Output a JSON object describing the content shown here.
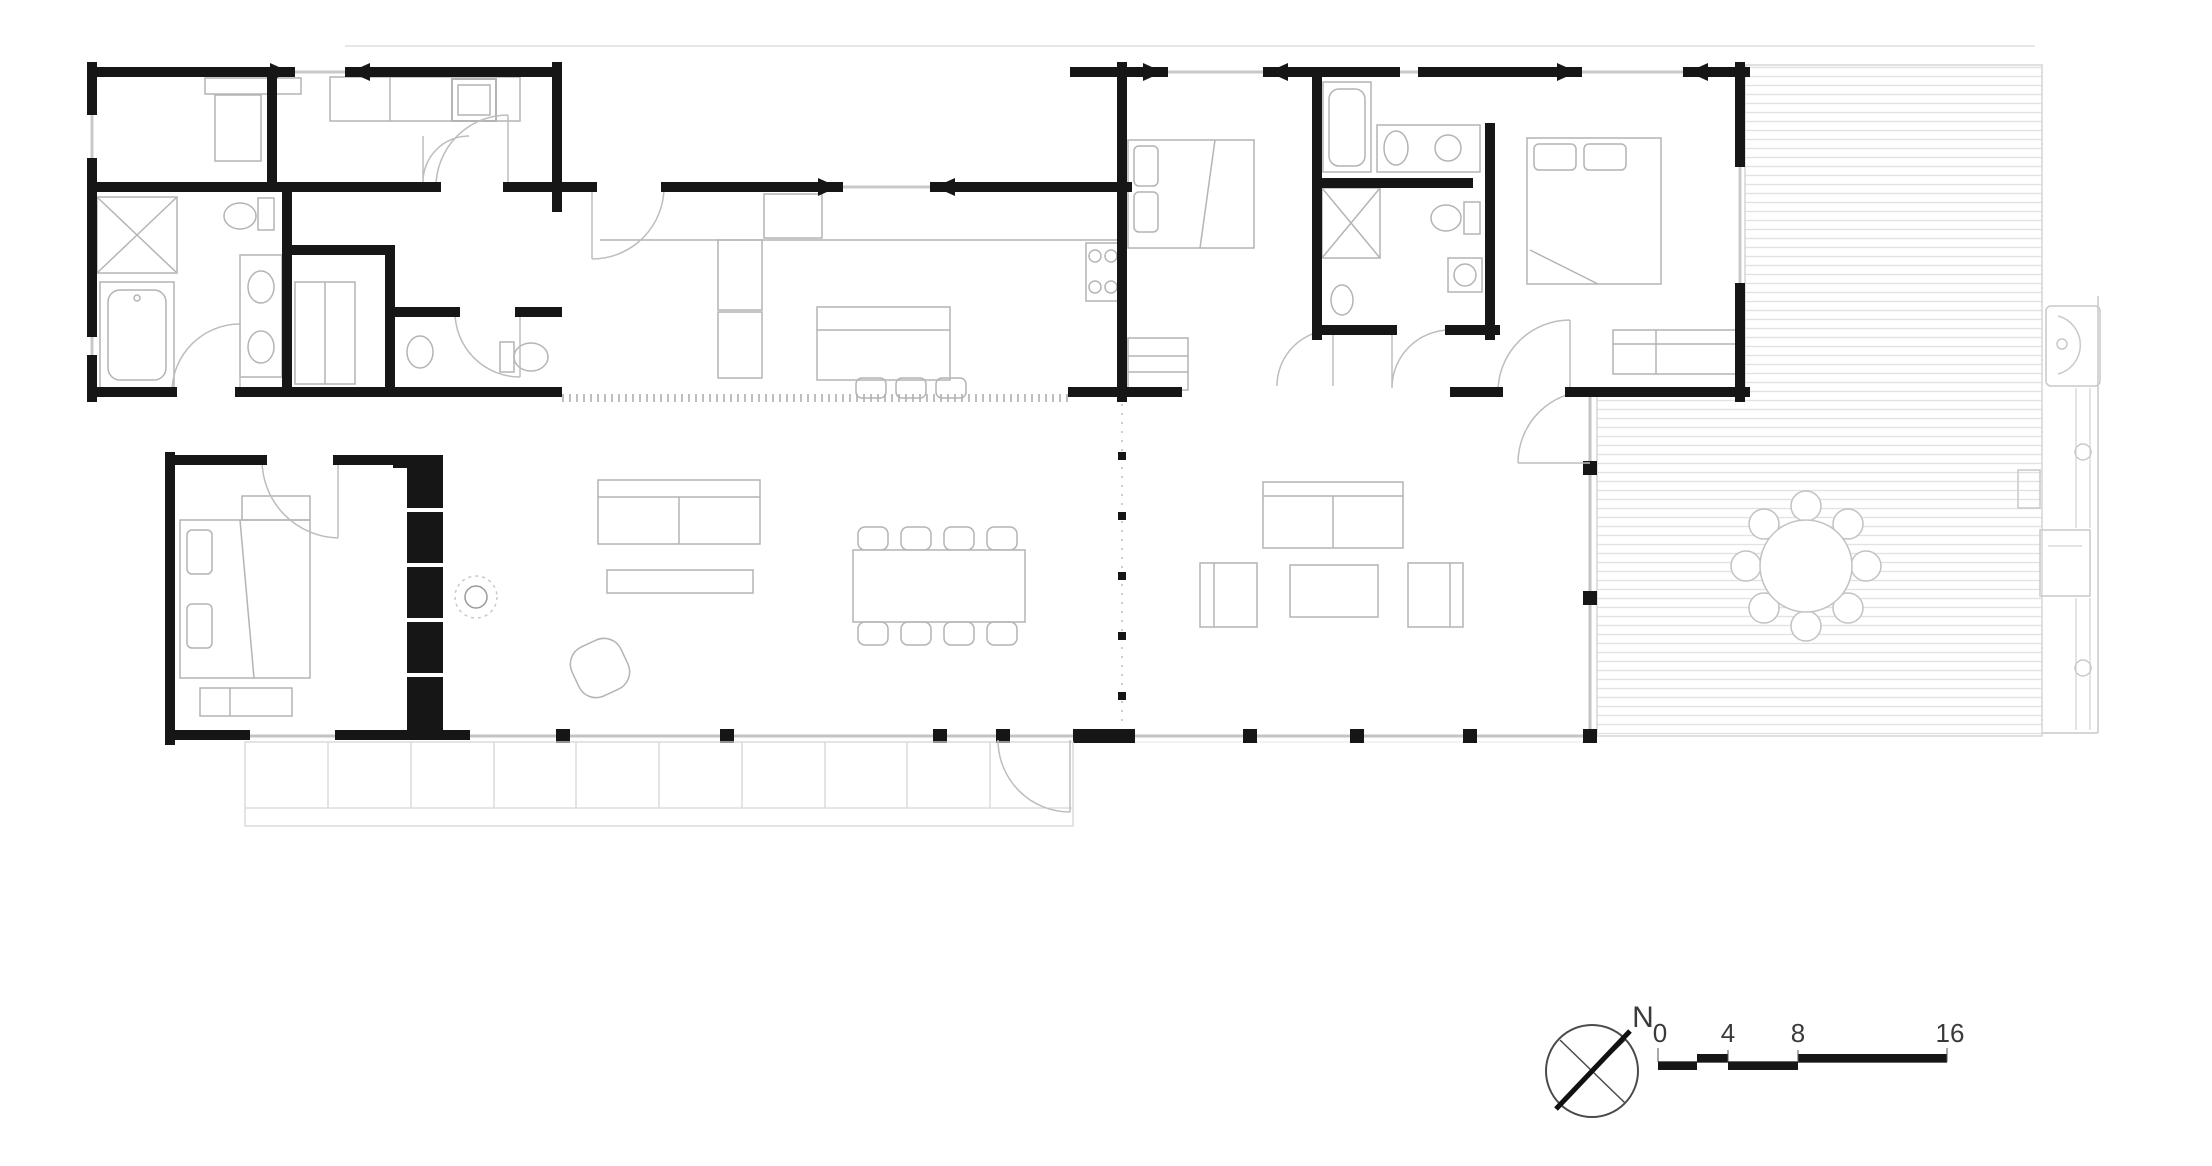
{
  "plan": {
    "type": "architectural-floor-plan",
    "north_indicator": {
      "label": "N"
    },
    "scale_bar": {
      "tick_labels": [
        "0",
        "4",
        "8",
        "16"
      ]
    },
    "colors": {
      "paper": "#ffffff",
      "wall": "#161616",
      "furniture_line": "#b4b4b4",
      "glazing_line": "#c9c9c9",
      "deck_stripe": "#e2e2e2",
      "hatch": "#8a8a8a",
      "label_text": "#3a3a3a"
    },
    "rooms": [
      "bedroom-1",
      "laundry",
      "bathroom-1",
      "wc",
      "powder-room",
      "kitchen",
      "dining-area",
      "master-bedroom",
      "family-room",
      "bedroom-2",
      "bathroom-2",
      "bedroom-3",
      "hall",
      "deck"
    ],
    "fixtures": [
      "shower",
      "bathtub",
      "double-vanity",
      "toilet",
      "washer",
      "closet",
      "kitchen-island",
      "bar-stools",
      "tall-cabinets",
      "cooktop",
      "dining-table-with-8-chairs",
      "sideboard",
      "wood-stove",
      "armchair",
      "shelving-wall",
      "bed",
      "dresser",
      "sofa",
      "coffee-table",
      "round-outdoor-table-with-8-chairs",
      "outdoor-sink",
      "grill",
      "paver-steps"
    ]
  }
}
